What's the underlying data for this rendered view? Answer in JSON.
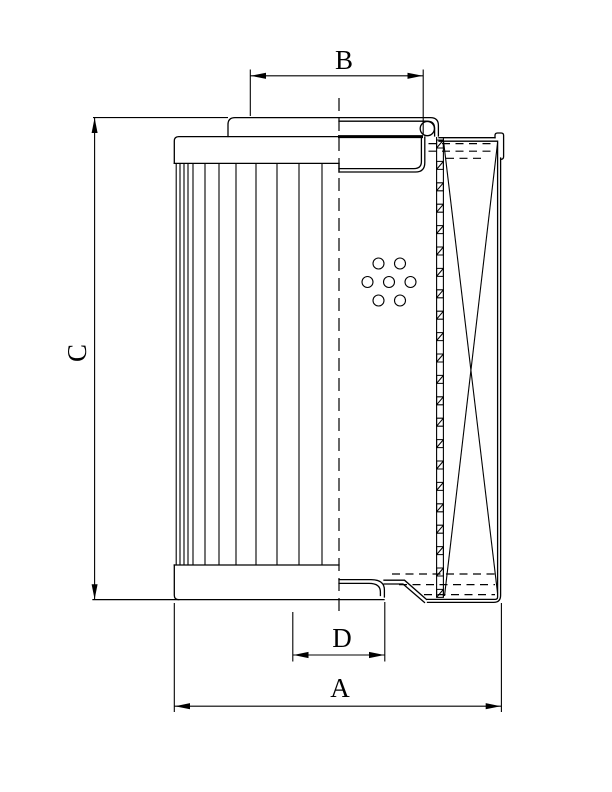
{
  "drawing": {
    "type": "technical-drawing",
    "subject": "filter element cross-section",
    "background_color": "#ffffff",
    "line_color": "#000000",
    "dimension_labels": {
      "top_cap_width": "B",
      "overall_height": "C",
      "inner_diameter_bottom": "D",
      "outer_width_bottom": "A"
    },
    "features": {
      "perforation_hole_count": 7,
      "pleat_line_count": 12,
      "core_tube_hatch_segments": 22
    }
  }
}
